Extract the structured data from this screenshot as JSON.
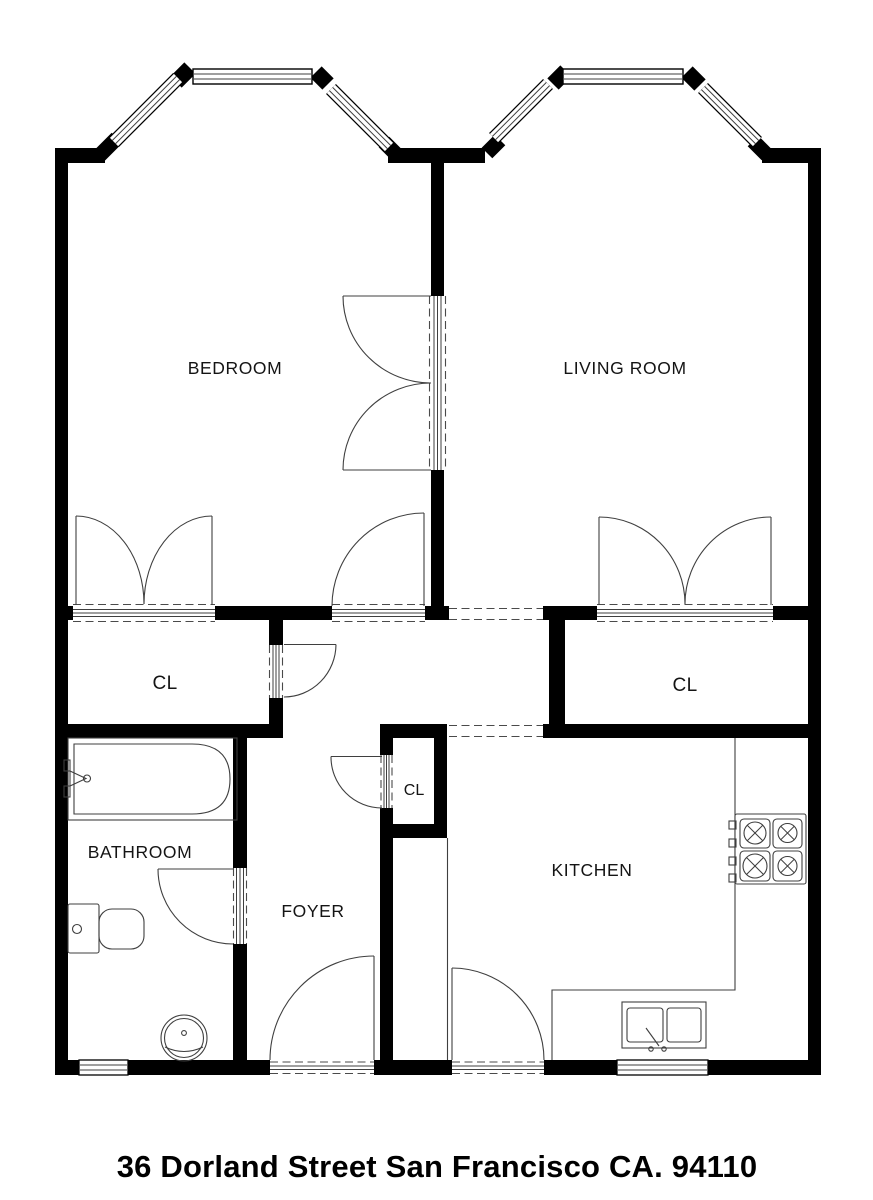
{
  "address": "36 Dorland Street San Francisco CA. 94110",
  "rooms": {
    "bedroom": "BEDROOM",
    "living_room": "LIVING ROOM",
    "closet_left": "CL",
    "closet_center": "CL",
    "closet_right": "CL",
    "bathroom": "BATHROOM",
    "foyer": "FOYER",
    "kitchen": "KITCHEN"
  },
  "fixtures": {
    "bathtub": "bathtub",
    "toilet": "toilet",
    "pedestal_sink": "pedestal-sink",
    "stove": "gas-cooktop",
    "kitchen_sink": "double-basin-sink",
    "counter": "kitchen-counter"
  },
  "colors": {
    "wall": "#000000",
    "line": "#3f3f3f",
    "background": "#ffffff",
    "text": "#141414"
  }
}
